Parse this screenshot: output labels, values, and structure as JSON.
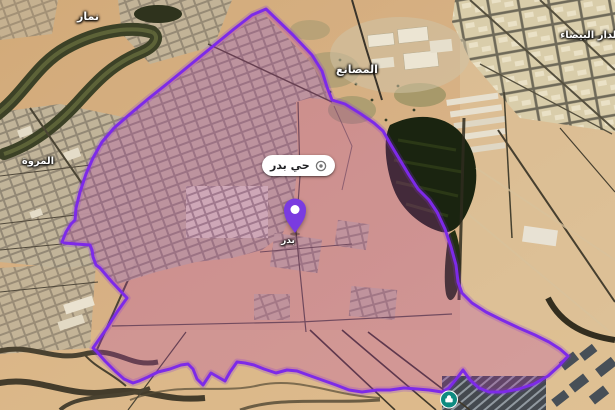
{
  "map": {
    "district_pill": {
      "label": "حي بدر"
    },
    "marker": {
      "sublabel": "بدر"
    },
    "labels": {
      "namar": "نمار",
      "marwah": "المروة",
      "masani": "المصانع",
      "dar_baida": "الدار البيضاء"
    },
    "colors": {
      "boundary": "#7d2ae8",
      "boundary_fill": "rgba(180,60,172,0.27)",
      "pin": "#7a3be0",
      "poi": "#0e8b80"
    }
  }
}
